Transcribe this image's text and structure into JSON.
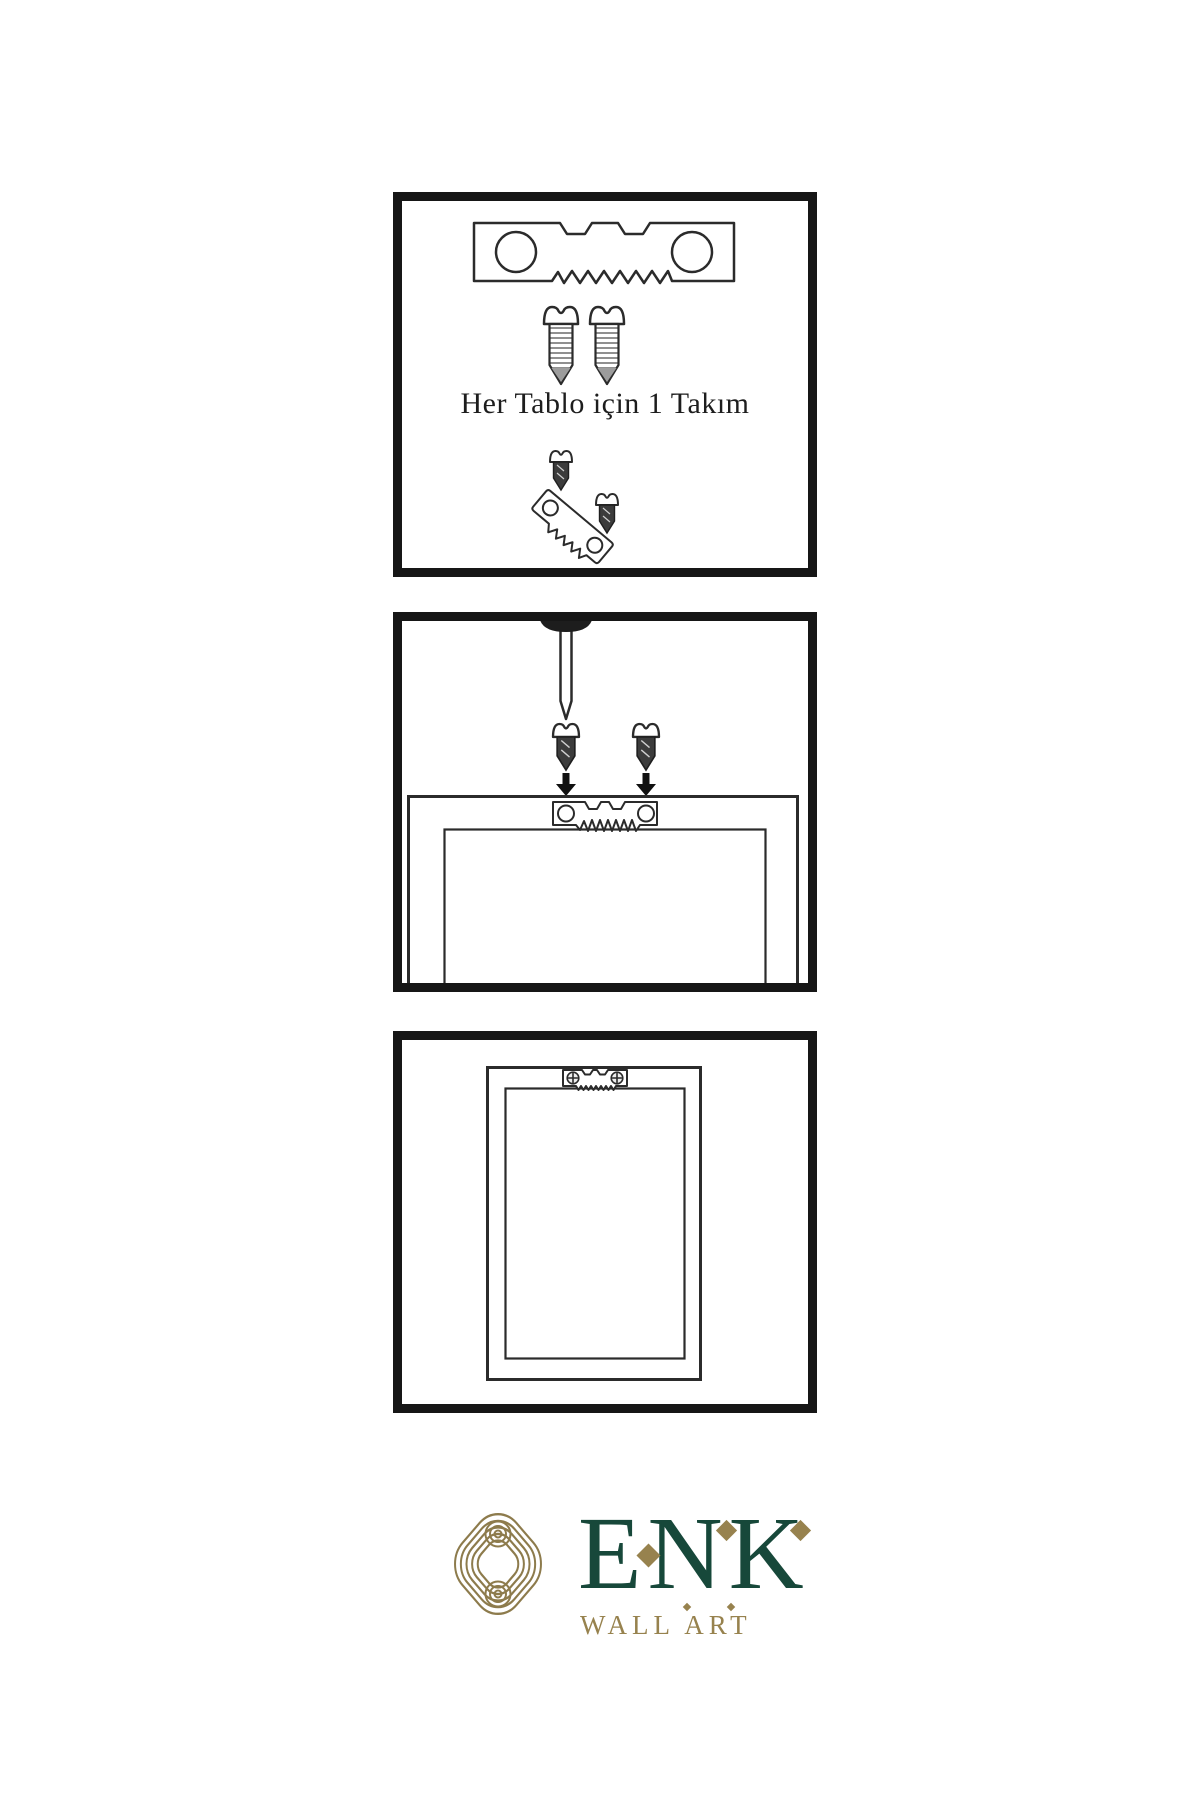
{
  "colors": {
    "bg": "#ffffff",
    "border": "#161616",
    "line": "#2b2b2b",
    "screw": "#3c3c3c",
    "green": "#17483a",
    "gold": "#97824e",
    "knot": "#8d7b4c"
  },
  "steps": {
    "step1": {
      "caption": "Her Tablo için 1 Takım",
      "contents": [
        "sawtooth-hanger",
        "mounting-screw",
        "mounting-screw",
        "angled-hanger-kit"
      ]
    },
    "step2": {
      "contents": [
        "wall-nail",
        "screw-with-down-arrow",
        "screw-with-down-arrow",
        "frame-back-top",
        "sawtooth-hanger-on-frame"
      ]
    },
    "step3": {
      "contents": [
        "frame-back",
        "installed-sawtooth-hanger"
      ]
    }
  },
  "logo": {
    "brand": "ENK",
    "subtitle": "WALL ART"
  }
}
